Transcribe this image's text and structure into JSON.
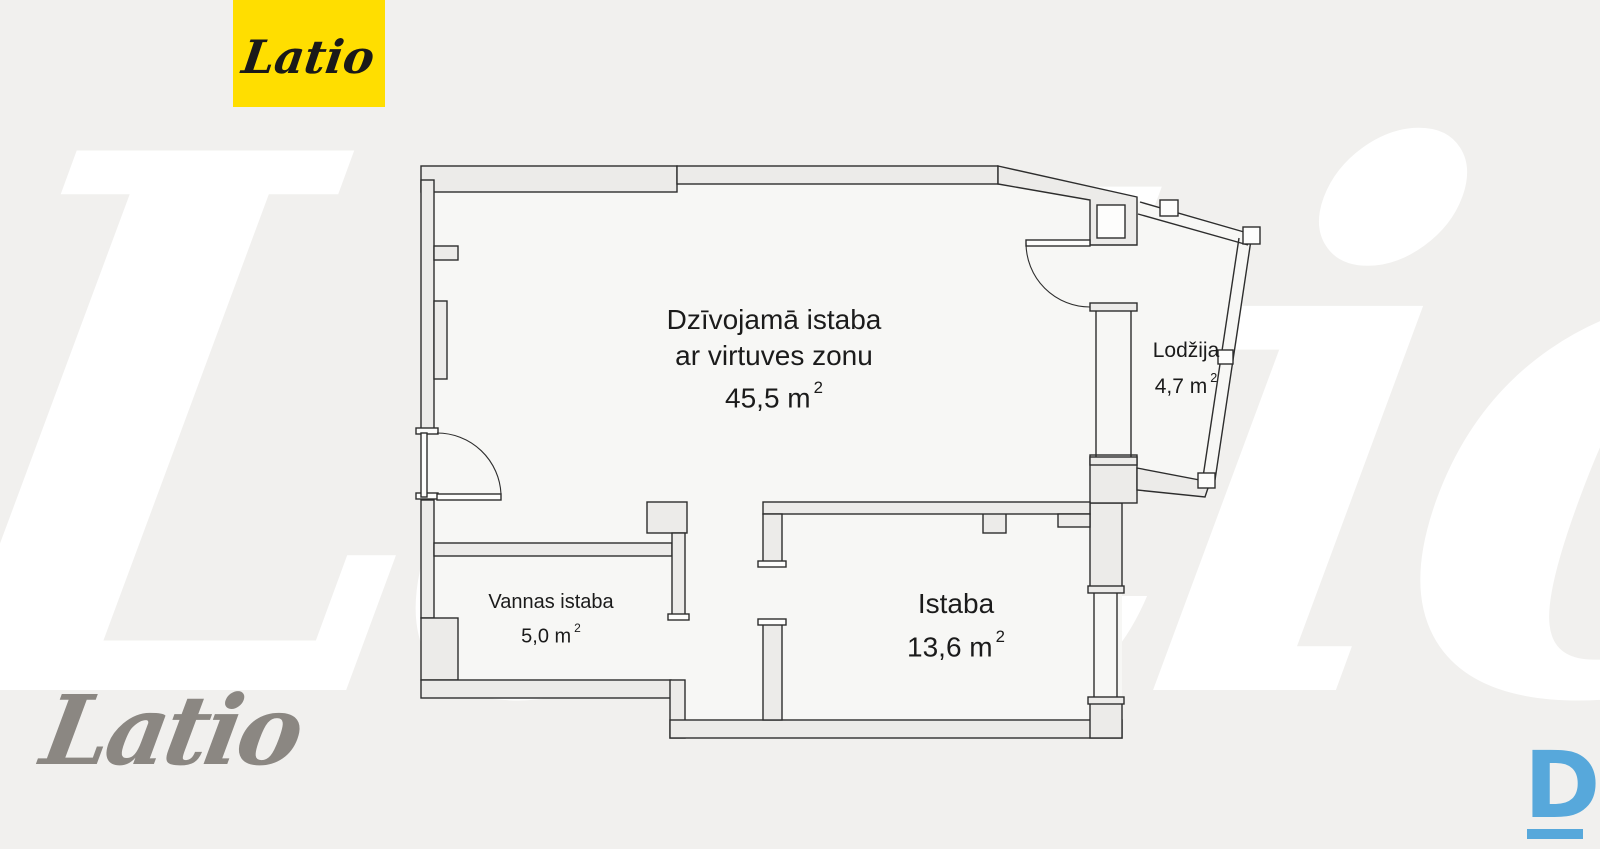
{
  "branding": {
    "logo_badge_text": "Latio",
    "watermark_text": "Latio",
    "footer_script_text": "Latio",
    "corner_mark_text": "D"
  },
  "floorplan": {
    "living_room": {
      "line1": "Dzīvojamā istaba",
      "line2": "ar virtuves zonu",
      "area": "45,5 m",
      "area_sup": "2"
    },
    "loggia": {
      "name": "Lodžija",
      "area": "4,7 m",
      "area_sup": "2"
    },
    "bathroom": {
      "name": "Vannas istaba",
      "area": "5,0 m",
      "area_sup": "2"
    },
    "room": {
      "name": "Istaba",
      "area": "13,6 m",
      "area_sup": "2"
    }
  },
  "colors": {
    "brand_yellow": "#FFDE00",
    "brand_blue": "#57A8DB",
    "wall_fill": "#ECEBE9",
    "plan_floor": "#F7F7F5",
    "line": "#2D2D2D",
    "background": "#F1F0EE",
    "footer_gray": "#8B8782"
  }
}
